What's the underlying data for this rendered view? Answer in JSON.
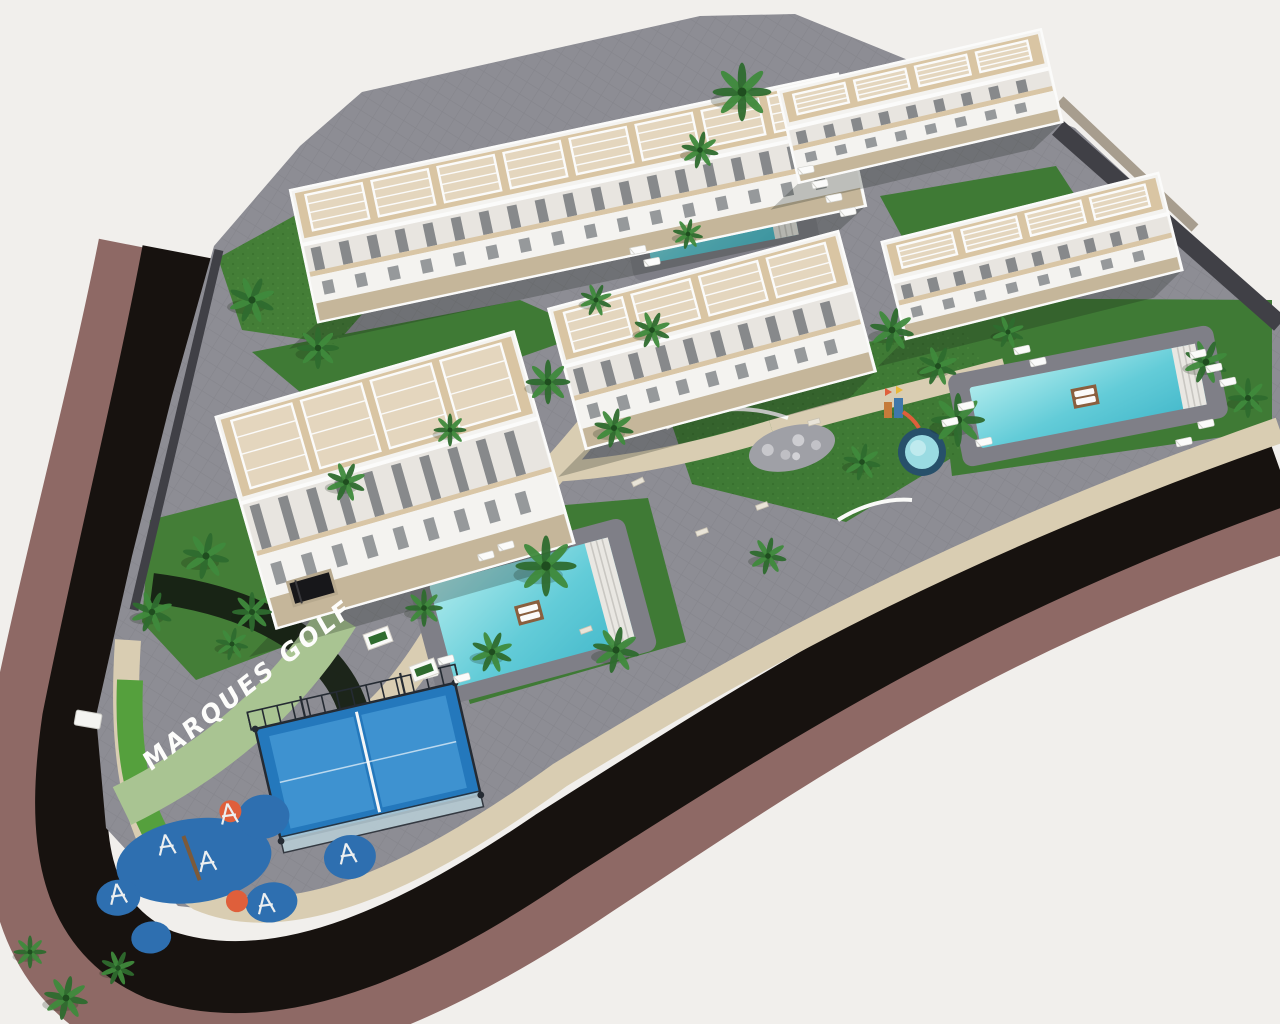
{
  "scene": {
    "type": "aerial-3d-architectural-render",
    "title_text": "MARQUES GOLF",
    "description": "Aerial rendering of Marques Golf residential complex: five white terraced apartment buildings, three large pools, a kids pool, padel court, playground, palm gardens, wrapped by a dark curved road"
  },
  "palette": {
    "bg": "#f1efec",
    "road": "#17120f",
    "mauve": "#8e6965",
    "beige": "#d9cdb2",
    "pavers": "#8d8d94",
    "lawn": "#3f7a35",
    "lawn2": "#447e37",
    "lawnBright": "#55a03d",
    "hedge": "#a9c492",
    "bedDark": "#162013",
    "wallDark": "#404046",
    "stoneBand": "#a79d8e",
    "poolDeck": "#7f7f87",
    "water": "#5fc9d6",
    "waterLight": "#a5e6e8",
    "building": "#f4f3f0",
    "buildingMid": "#e8e5e0",
    "roofWood": "#d9c5a3",
    "stoneBase": "#c5b69a",
    "floorTan": "#d9c6a6",
    "slotDark": "#6e7276",
    "white": "#fbfbfa",
    "padel": "#2478bc",
    "padelLight": "#3e92d0",
    "fence": "#252b33",
    "glass": "#b9cfd8",
    "playBlue": "#2e6fb0",
    "playOrange": "#df5f3b",
    "palmDark": "#2e6b2e",
    "palmLight": "#3f8a3c",
    "trunk": "#7c5a3a",
    "shadow": "rgba(25,30,22,0.25)"
  },
  "label": {
    "x": 150,
    "y": 772,
    "rot": -38,
    "skew": -8
  },
  "buildings": [
    {
      "id": "building-1",
      "cx": 578,
      "cy": 198,
      "w": 560,
      "h": 135,
      "rot": -12
    },
    {
      "id": "building-2",
      "cx": 920,
      "cy": 106,
      "w": 270,
      "h": 95,
      "rot": -13
    },
    {
      "id": "building-3",
      "cx": 1032,
      "cy": 256,
      "w": 285,
      "h": 100,
      "rot": -14
    },
    {
      "id": "building-4",
      "cx": 712,
      "cy": 340,
      "w": 300,
      "h": 145,
      "rot": -15
    },
    {
      "id": "building-5",
      "cx": 395,
      "cy": 480,
      "w": 310,
      "h": 220,
      "rot": -16
    }
  ],
  "pools": [
    {
      "id": "pool-top",
      "cx": 718,
      "cy": 212,
      "w": 150,
      "h": 75,
      "rot": -11
    },
    {
      "id": "pool-right",
      "cx": 1088,
      "cy": 396,
      "w": 230,
      "h": 62,
      "rot": -11
    },
    {
      "id": "pool-center",
      "cx": 532,
      "cy": 612,
      "w": 185,
      "h": 105,
      "rot": -15
    }
  ],
  "kids_pool": {
    "cx": 922,
    "cy": 452,
    "r": 20
  },
  "padel_court": {
    "cx": 368,
    "cy": 762,
    "w": 205,
    "h": 115,
    "rot": -13
  },
  "playground": {
    "cx": 200,
    "cy": 868,
    "rot": -8,
    "blobs": [
      {
        "x": -5,
        "y": -8,
        "rx": 78,
        "ry": 42
      },
      {
        "x": 70,
        "y": -42,
        "rx": 26,
        "ry": 22
      },
      {
        "x": -85,
        "y": 18,
        "rx": 22,
        "ry": 18
      },
      {
        "x": 66,
        "y": 44,
        "rx": 26,
        "ry": 20
      },
      {
        "x": -58,
        "y": 62,
        "rx": 20,
        "ry": 16
      },
      {
        "x": 150,
        "y": 10,
        "rx": 26,
        "ry": 22
      }
    ],
    "orange_dots": [
      {
        "x": 38,
        "y": -52,
        "r": 11
      },
      {
        "x": 32,
        "y": 38,
        "r": 11
      }
    ]
  },
  "palms": [
    [
      742,
      92,
      1.25
    ],
    [
      700,
      150,
      0.8
    ],
    [
      252,
      300,
      1.0
    ],
    [
      318,
      348,
      0.9
    ],
    [
      206,
      556,
      1.0
    ],
    [
      152,
      612,
      0.9
    ],
    [
      252,
      612,
      0.85
    ],
    [
      232,
      644,
      0.7
    ],
    [
      346,
      482,
      0.85
    ],
    [
      548,
      382,
      0.95
    ],
    [
      614,
      428,
      0.85
    ],
    [
      652,
      330,
      0.8
    ],
    [
      546,
      566,
      1.3
    ],
    [
      616,
      650,
      1.0
    ],
    [
      492,
      652,
      0.9
    ],
    [
      424,
      608,
      0.8
    ],
    [
      892,
      330,
      0.95
    ],
    [
      938,
      366,
      0.85
    ],
    [
      958,
      420,
      1.15
    ],
    [
      862,
      462,
      0.8
    ],
    [
      1206,
      362,
      0.95
    ],
    [
      1248,
      398,
      0.85
    ],
    [
      66,
      998,
      0.95
    ],
    [
      118,
      968,
      0.75
    ],
    [
      30,
      952,
      0.7
    ],
    [
      688,
      234,
      0.65
    ],
    [
      596,
      300,
      0.7
    ],
    [
      450,
      430,
      0.7
    ],
    [
      768,
      556,
      0.8
    ],
    [
      1008,
      332,
      0.7
    ]
  ],
  "loungers": [
    [
      806,
      170,
      -11
    ],
    [
      820,
      184,
      -11
    ],
    [
      834,
      198,
      -11
    ],
    [
      848,
      212,
      -11
    ],
    [
      638,
      250,
      -11
    ],
    [
      652,
      262,
      -11
    ],
    [
      1198,
      354,
      -12
    ],
    [
      1214,
      368,
      -12
    ],
    [
      1228,
      382,
      -12
    ],
    [
      1206,
      424,
      -12
    ],
    [
      1184,
      442,
      -12
    ],
    [
      966,
      406,
      -12
    ],
    [
      950,
      422,
      -12
    ],
    [
      984,
      442,
      -12
    ],
    [
      446,
      660,
      -15
    ],
    [
      430,
      674,
      -15
    ],
    [
      462,
      678,
      -15
    ],
    [
      486,
      556,
      -15
    ],
    [
      506,
      546,
      -15
    ],
    [
      1022,
      350,
      -12
    ],
    [
      1038,
      362,
      -12
    ]
  ],
  "benches": [
    [
      814,
      422,
      -15
    ],
    [
      762,
      506,
      -20
    ],
    [
      702,
      532,
      -20
    ],
    [
      638,
      482,
      -25
    ],
    [
      586,
      630,
      -20
    ]
  ],
  "planters": [
    [
      378,
      638,
      -20
    ],
    [
      424,
      670,
      -20
    ]
  ],
  "shelter": {
    "x": 88,
    "y": 720,
    "rot": 10
  },
  "parking_ramp": {
    "x": 312,
    "y": 588,
    "rot": -16
  },
  "boulder_bed": {
    "x": 792,
    "y": 448
  },
  "kids_structure": {
    "x": 893,
    "y": 406
  }
}
